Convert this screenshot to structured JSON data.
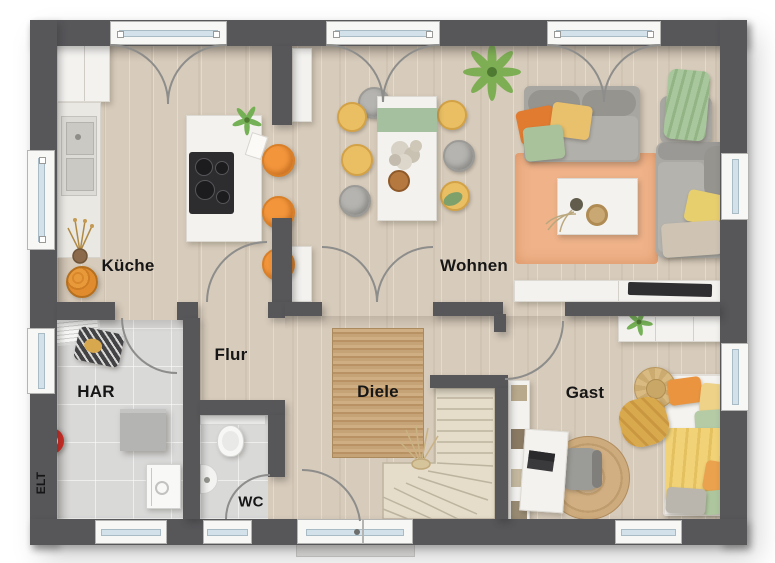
{
  "rooms": [
    {
      "id": "kueche",
      "label": "Küche"
    },
    {
      "id": "wohnen",
      "label": "Wohnen"
    },
    {
      "id": "flur",
      "label": "Flur"
    },
    {
      "id": "diele",
      "label": "Diele"
    },
    {
      "id": "har",
      "label": "HAR"
    },
    {
      "id": "elt",
      "label": "ELT"
    },
    {
      "id": "wc",
      "label": "WC"
    },
    {
      "id": "gast",
      "label": "Gast"
    }
  ],
  "colors": {
    "wall": "#57575a",
    "wood_floor": "#d7cbbb",
    "tile_floor": "#d9d9d8",
    "jute_rug": "#c2a176",
    "orange_rug": "#efb289",
    "stool_orange": "#f2953b",
    "chair_yellow": "#eabf63",
    "sofa_gray": "#a8a6a1",
    "pillow_green": "#a9c29b",
    "plant_green": "#79ad4f",
    "red_item": "#cf2b24",
    "window_glass": "#d3e2ea"
  }
}
